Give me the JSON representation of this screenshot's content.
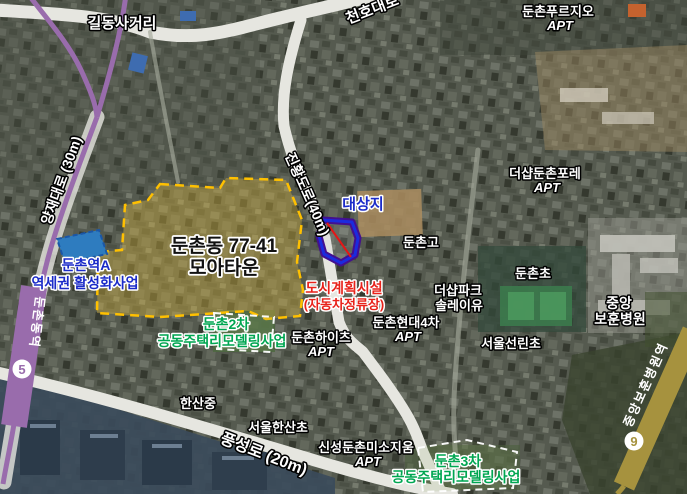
{
  "map": {
    "roads": {
      "gildong_intersection": "길동사거리",
      "cheonho": "천호대로",
      "yangjae": "양재대로 (30m)",
      "jinhwang": "진황도로(40m)",
      "pungseong": "풍성로 (20m)"
    },
    "subway": {
      "line5": {
        "number": "5",
        "station": "둔촌동역",
        "color": "#996CAC"
      },
      "line9": {
        "number": "9",
        "station": "중앙보훈병원역",
        "color": "#A6923E"
      }
    },
    "projects": {
      "moatown": {
        "line1": "둔촌동 77-41",
        "line2": "모아타운",
        "border_color": "#FFC000"
      },
      "station_a": {
        "line1": "둔촌역A",
        "line2": "역세권 활성화사업",
        "color": "#1B2BC8"
      },
      "site": {
        "label": "대상지",
        "outline_outer": "#43108F",
        "outline_inner": "#1B2BDE"
      },
      "facility": {
        "line1": "도시계획시설",
        "line2": "(자동차정류장)",
        "color": "#E8221A"
      },
      "remodel2": {
        "line1": "둔촌2차",
        "line2": "공동주택리모델링사업",
        "color": "#00A651"
      },
      "remodel3": {
        "line1": "둔촌3차",
        "line2": "공동주택리모델링사업",
        "color": "#00A651"
      }
    },
    "places": {
      "purgio": {
        "line1": "둔촌푸르지오",
        "line2": "APT"
      },
      "fore": {
        "line1": "더샵둔촌포레",
        "line2": "APT"
      },
      "parc": {
        "line1": "더샵파크",
        "line2": "솔레이유"
      },
      "hyundai4": {
        "line1": "둔촌현대4차",
        "line2": "APT"
      },
      "heights": {
        "line1": "둔촌하이츠",
        "line2": "APT"
      },
      "misozium": {
        "line1": "신성둔촌미소지움",
        "line2": "APT"
      },
      "hospital": {
        "line1": "중앙",
        "line2": "보훈병원"
      },
      "dunchon_high": "둔촌고",
      "dunchon_elem": "둔촌초",
      "hyundai4_label": "둔촌현대4차",
      "sunrin_elem": "서울선린초",
      "hansan_mid": "한산중",
      "hansan_elem": "서울한산초"
    }
  }
}
